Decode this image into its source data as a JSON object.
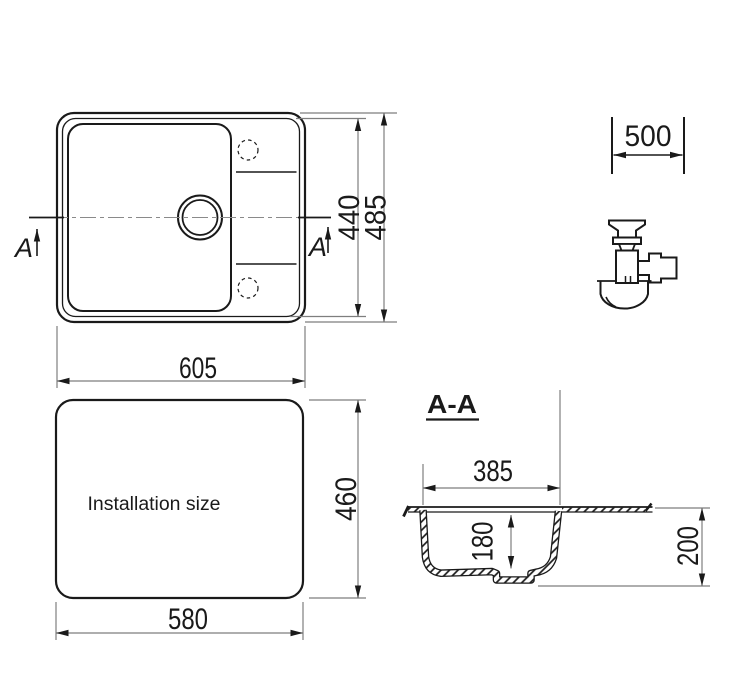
{
  "colors": {
    "background": "#ffffff",
    "object_line": "#1a1a1a",
    "dimension_line": "#7e7e7e"
  },
  "top_view": {
    "section_label_left": "A",
    "section_label_right": "A",
    "width": "605",
    "height_inner": "440",
    "height_outer": "485"
  },
  "cabinet": {
    "min_width": "500"
  },
  "installation": {
    "label": "Installation size",
    "width": "580",
    "depth": "460"
  },
  "section": {
    "title": "A-A",
    "bowl_width": "385",
    "bowl_depth": "180",
    "overall_height": "200"
  }
}
